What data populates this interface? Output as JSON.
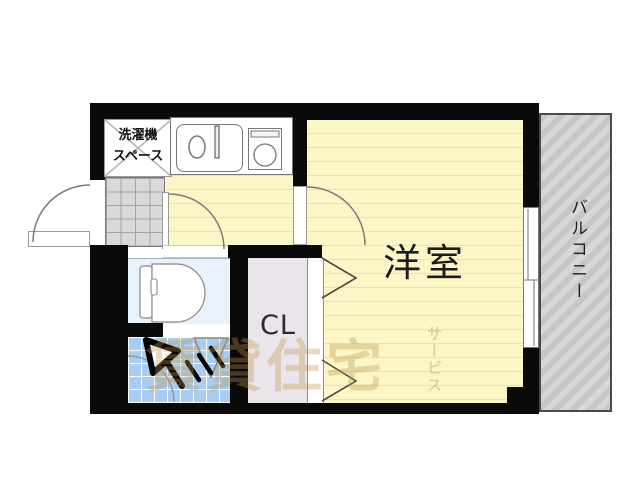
{
  "floorplan": {
    "labels": {
      "main_room": "洋室",
      "closet": "CL",
      "balcony": "バルコニー",
      "laundry_line1": "洗濯機",
      "laundry_line2": "スペース"
    },
    "watermark": {
      "main": "賃貸住宅",
      "sub": "サービス"
    },
    "colors": {
      "wall_black": "#0a0a0a",
      "floor_yellow": "#fcf6c7",
      "floor_stripe": "#f0e2a4",
      "bath_tile_blue": "#a8cdf1",
      "toilet_room_blue": "#e9f1fb",
      "closet_gray": "#eae5eb",
      "balcony_gray": "#c6c6c6",
      "genkan_tile_gray": "#d9d9d9",
      "watermark_orange": "#c19648"
    },
    "icons": [
      "entrance-door-arc",
      "room-door-arc",
      "toilet-door-arc",
      "closet-bifold-door",
      "bath-folding-door",
      "toilet-icon",
      "shower-icon",
      "kitchen-sink-icon",
      "stove-icon",
      "washer-space-x",
      "sliding-window"
    ]
  }
}
